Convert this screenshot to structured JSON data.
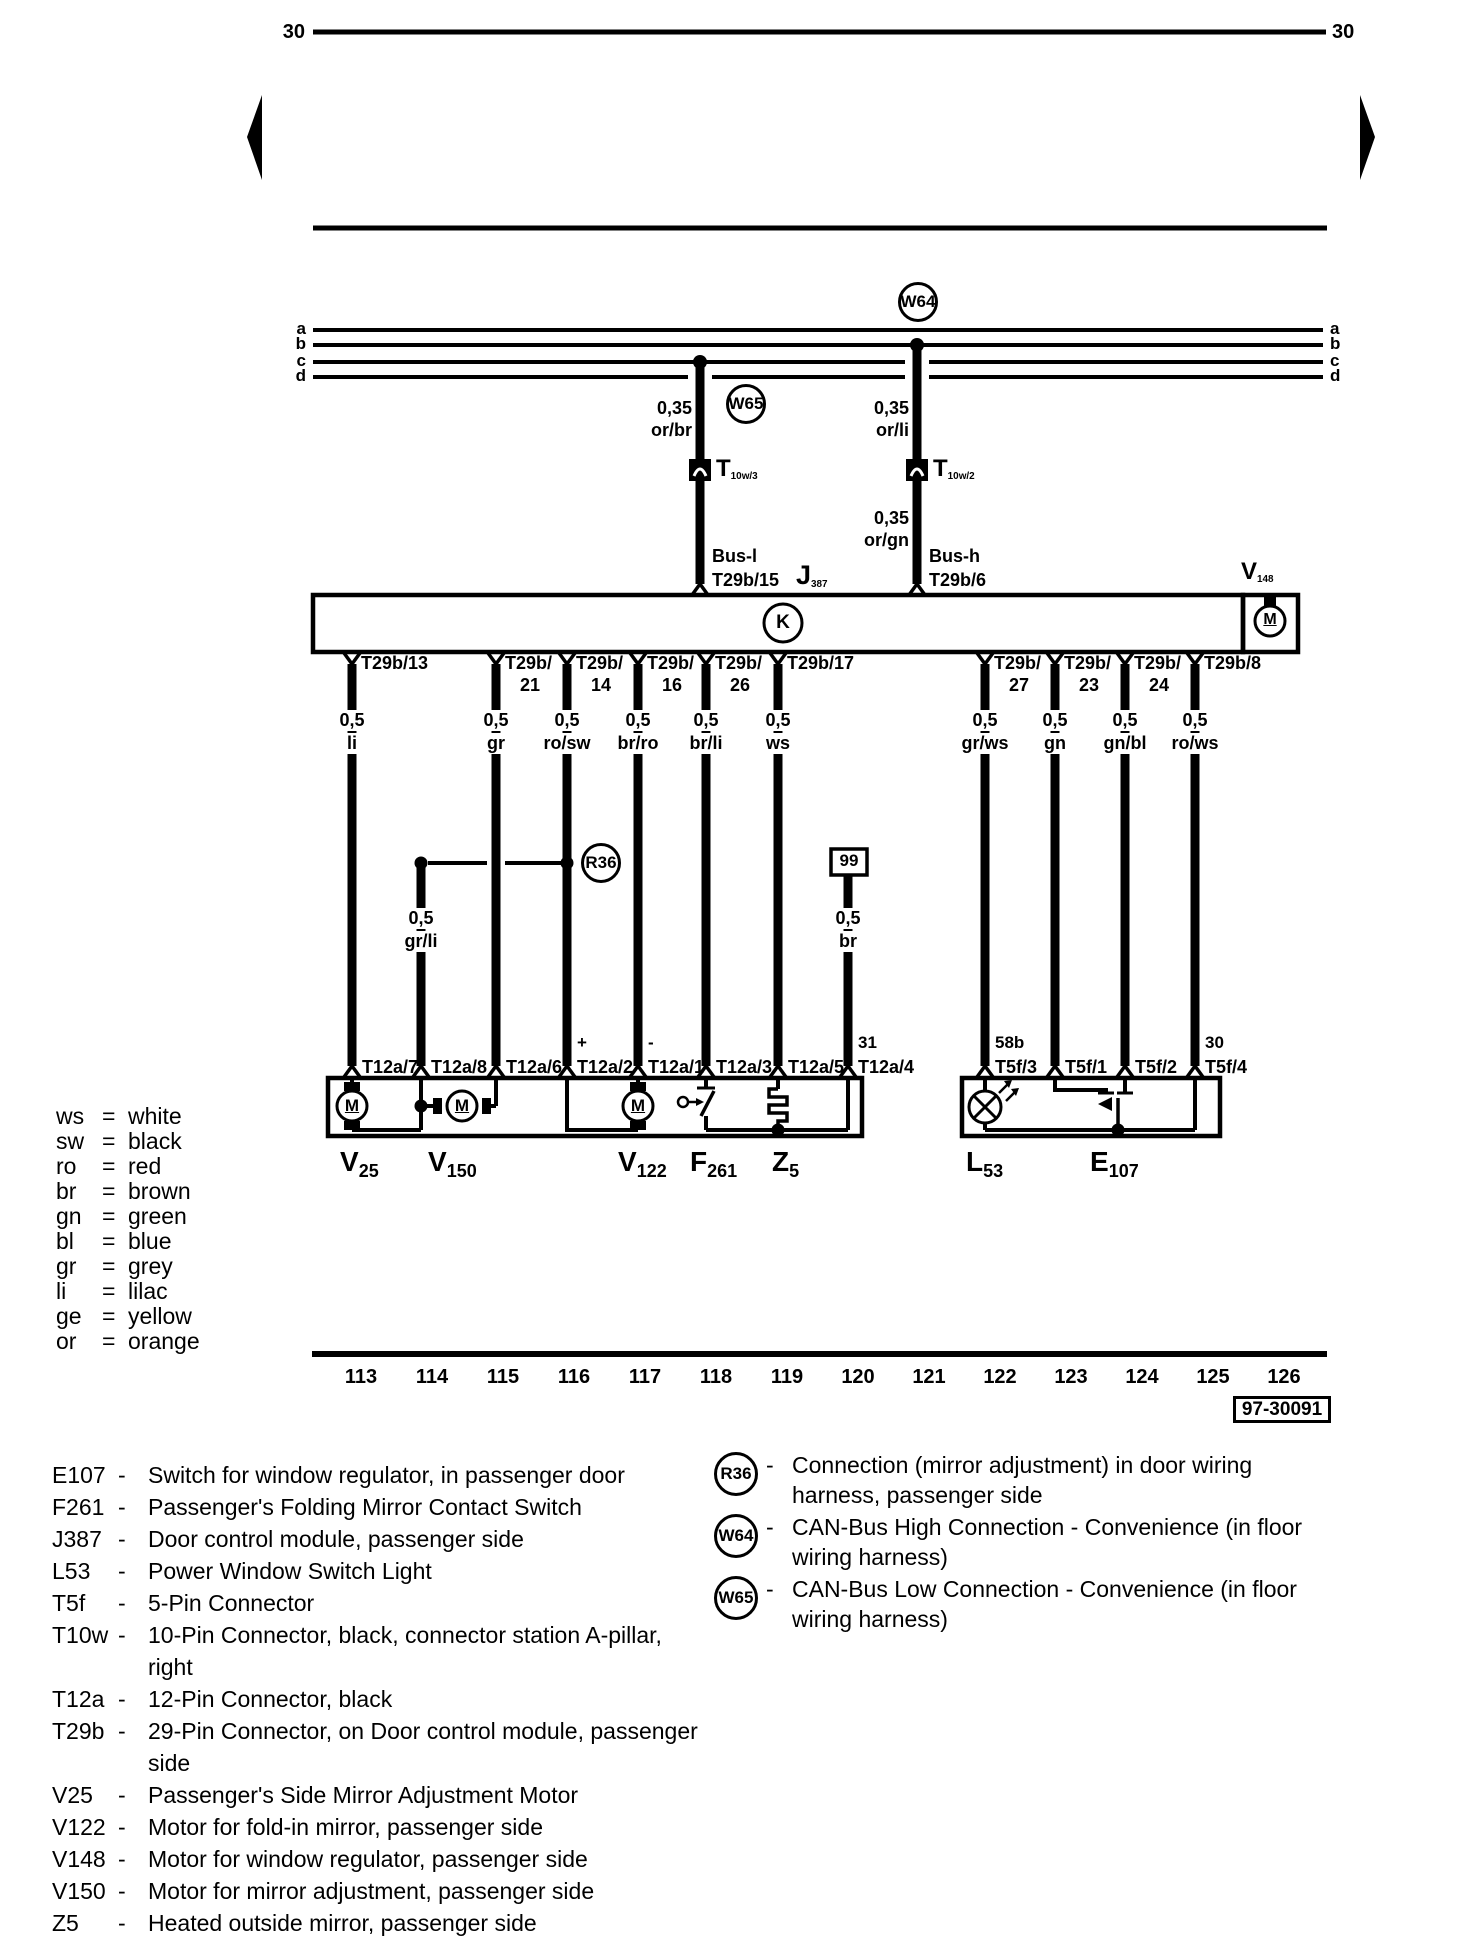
{
  "page": {
    "bg": "#ffffff",
    "ink": "#000000"
  },
  "terminals": {
    "left": "30",
    "right": "30"
  },
  "rails": {
    "labels": [
      "a",
      "b",
      "c",
      "d"
    ]
  },
  "can": {
    "w64": "W64",
    "w65": "W65",
    "left": {
      "gauge": "0,35",
      "color": "or/br"
    },
    "right_upper": {
      "gauge": "0,35",
      "color": "or/li"
    },
    "right_lower": {
      "gauge": "0,35",
      "color": "or/gn"
    },
    "t10w3": {
      "main": "T",
      "sub": "10w/3"
    },
    "t10w2": {
      "main": "T",
      "sub": "10w/2"
    },
    "bus_l": "Bus-l",
    "bus_l_pin": "T29b/15",
    "bus_h": "Bus-h",
    "bus_h_pin": "T29b/6"
  },
  "module": {
    "j387": {
      "main": "J",
      "sub": "387"
    },
    "k": "K",
    "v148": {
      "main": "V",
      "sub": "148"
    }
  },
  "symbols": {
    "motor_letter": "M"
  },
  "branch": {
    "r36": "R36",
    "gauge": "0,5",
    "color": "gr/li"
  },
  "ground": {
    "id": "99",
    "gauge": "0,5",
    "color": "br"
  },
  "pins": [
    {
      "x": 352,
      "line1": "T29b/13",
      "line2": "",
      "gauge": "0,5",
      "color": "li"
    },
    {
      "x": 496,
      "line1": "T29b/",
      "line2": "21",
      "gauge": "0,5",
      "color": "gr"
    },
    {
      "x": 567,
      "line1": "T29b/",
      "line2": "14",
      "gauge": "0,5",
      "color": "ro/sw"
    },
    {
      "x": 638,
      "line1": "T29b/",
      "line2": "16",
      "gauge": "0,5",
      "color": "br/ro"
    },
    {
      "x": 706,
      "line1": "T29b/",
      "line2": "26",
      "gauge": "0,5",
      "color": "br/li"
    },
    {
      "x": 778,
      "line1": "T29b/17",
      "line2": "",
      "gauge": "0,5",
      "color": "ws"
    },
    {
      "x": 985,
      "line1": "T29b/",
      "line2": "27",
      "gauge": "0,5",
      "color": "gr/ws"
    },
    {
      "x": 1055,
      "line1": "T29b/",
      "line2": "23",
      "gauge": "0,5",
      "color": "gn"
    },
    {
      "x": 1125,
      "line1": "T29b/",
      "line2": "24",
      "gauge": "0,5",
      "color": "gn/bl"
    },
    {
      "x": 1195,
      "line1": "T29b/8",
      "line2": "",
      "gauge": "0,5",
      "color": "ro/ws"
    }
  ],
  "connectors": [
    {
      "x": 352,
      "prefix": "",
      "label": "T12a/7"
    },
    {
      "x": 421,
      "prefix": "",
      "label": "T12a/8"
    },
    {
      "x": 496,
      "prefix": "",
      "label": "T12a/6"
    },
    {
      "x": 567,
      "prefix": "+",
      "label": "T12a/2"
    },
    {
      "x": 638,
      "prefix": "-",
      "label": "T12a/1"
    },
    {
      "x": 706,
      "prefix": "",
      "label": "T12a/3"
    },
    {
      "x": 778,
      "prefix": "",
      "label": "T12a/5"
    },
    {
      "x": 848,
      "prefix": "31",
      "label": "T12a/4"
    },
    {
      "x": 985,
      "prefix": "58b",
      "label": "T5f/3"
    },
    {
      "x": 1055,
      "prefix": "",
      "label": "T5f/1"
    },
    {
      "x": 1125,
      "prefix": "",
      "label": "T5f/2"
    },
    {
      "x": 1195,
      "prefix": "30",
      "label": "T5f/4"
    }
  ],
  "components": [
    {
      "x": 340,
      "main": "V",
      "sub": "25"
    },
    {
      "x": 428,
      "main": "V",
      "sub": "150"
    },
    {
      "x": 618,
      "main": "V",
      "sub": "122"
    },
    {
      "x": 690,
      "main": "F",
      "sub": "261"
    },
    {
      "x": 772,
      "main": "Z",
      "sub": "5"
    },
    {
      "x": 966,
      "main": "L",
      "sub": "53"
    },
    {
      "x": 1090,
      "main": "E",
      "sub": "107"
    }
  ],
  "tracks": [
    {
      "x": 361,
      "label": "113"
    },
    {
      "x": 432,
      "label": "114"
    },
    {
      "x": 503,
      "label": "115"
    },
    {
      "x": 574,
      "label": "116"
    },
    {
      "x": 645,
      "label": "117"
    },
    {
      "x": 716,
      "label": "118"
    },
    {
      "x": 787,
      "label": "119"
    },
    {
      "x": 858,
      "label": "120"
    },
    {
      "x": 929,
      "label": "121"
    },
    {
      "x": 1000,
      "label": "122"
    },
    {
      "x": 1071,
      "label": "123"
    },
    {
      "x": 1142,
      "label": "124"
    },
    {
      "x": 1213,
      "label": "125"
    },
    {
      "x": 1284,
      "label": "126"
    }
  ],
  "plate": "97-30091",
  "color_legend": [
    {
      "abbr": "ws",
      "eq": "=",
      "name": "white"
    },
    {
      "abbr": "sw",
      "eq": "=",
      "name": "black"
    },
    {
      "abbr": "ro",
      "eq": "=",
      "name": "red"
    },
    {
      "abbr": "br",
      "eq": "=",
      "name": "brown"
    },
    {
      "abbr": "gn",
      "eq": "=",
      "name": "green"
    },
    {
      "abbr": "bl",
      "eq": "=",
      "name": "blue"
    },
    {
      "abbr": "gr",
      "eq": "=",
      "name": "grey"
    },
    {
      "abbr": "li",
      "eq": "=",
      "name": "lilac"
    },
    {
      "abbr": "ge",
      "eq": "=",
      "name": "yellow"
    },
    {
      "abbr": "or",
      "eq": "=",
      "name": "orange"
    }
  ],
  "legend_left": [
    {
      "key": "E107",
      "dash": "-",
      "desc": "Switch for window regulator, in passenger door"
    },
    {
      "key": "F261",
      "dash": "-",
      "desc": "Passenger's Folding Mirror Contact Switch"
    },
    {
      "key": "J387",
      "dash": "-",
      "desc": "Door control module, passenger side"
    },
    {
      "key": "L53",
      "dash": "-",
      "desc": "Power Window Switch Light"
    },
    {
      "key": "T5f",
      "dash": "-",
      "desc": "5-Pin Connector"
    },
    {
      "key": "T10w",
      "dash": "-",
      "desc": "10-Pin Connector, black, connector station A-pillar, right"
    },
    {
      "key": "T12a",
      "dash": "-",
      "desc": "12-Pin Connector, black"
    },
    {
      "key": "T29b",
      "dash": "-",
      "desc": "29-Pin Connector, on Door control module, passenger side"
    },
    {
      "key": "V25",
      "dash": "-",
      "desc": "Passenger's Side Mirror Adjustment Motor"
    },
    {
      "key": "V122",
      "dash": "-",
      "desc": "Motor for fold-in mirror, passenger side"
    },
    {
      "key": "V148",
      "dash": "-",
      "desc": "Motor for window regulator, passenger side"
    },
    {
      "key": "V150",
      "dash": "-",
      "desc": "Motor for mirror adjustment, passenger side"
    },
    {
      "key": "Z5",
      "dash": "-",
      "desc": "Heated outside mirror, passenger side"
    }
  ],
  "legend_right": [
    {
      "key": "R36",
      "dash": "-",
      "desc": "Connection (mirror adjustment) in door wiring harness, passenger side"
    },
    {
      "key": "W64",
      "dash": "-",
      "desc": "CAN-Bus High Connection - Convenience (in floor wiring harness)"
    },
    {
      "key": "W65",
      "dash": "-",
      "desc": "CAN-Bus Low Connection - Convenience (in floor wiring harness)"
    }
  ]
}
